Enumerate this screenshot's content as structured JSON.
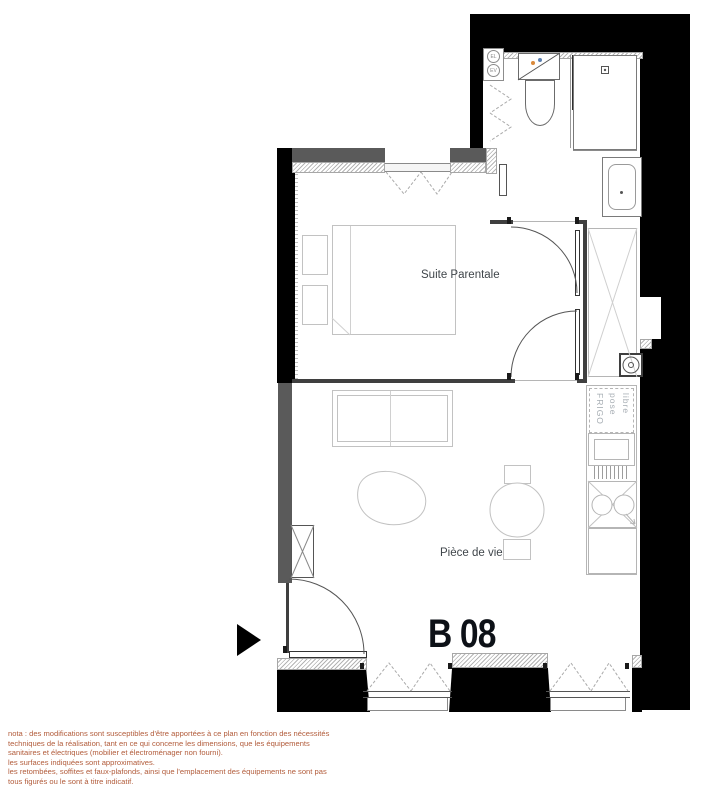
{
  "plan": {
    "unit_label": "B 08",
    "rooms": {
      "bedroom": "Suite Parentale",
      "living": "Pièce de vie"
    },
    "kitchen": {
      "fridge_lines": [
        "FRIGO",
        "pose",
        "libre"
      ]
    },
    "shafts": {
      "el": "EL",
      "ev": "EV"
    },
    "colors": {
      "wall": "#000000",
      "wall_secondary": "#5a5a5a",
      "fixture_line": "#c2c2c2",
      "room_label": "#40464b",
      "unit_label": "#0d1117",
      "note_text": "#b25c3b"
    }
  },
  "footer": {
    "lines": [
      "nota : des modifications sont susceptibles d'être apportées à ce plan en fonction des nécessités",
      "techniques de la réalisation, tant en ce qui concerne les dimensions, que les équipements",
      "sanitaires et électriques (mobilier et électroménager non fourni).",
      "les surfaces indiquées sont approximatives.",
      "les retombées, soffites et faux-plafonds, ainsi que l'emplacement des équipements ne sont pas",
      "tous figurés ou le sont à titre indicatif."
    ]
  }
}
